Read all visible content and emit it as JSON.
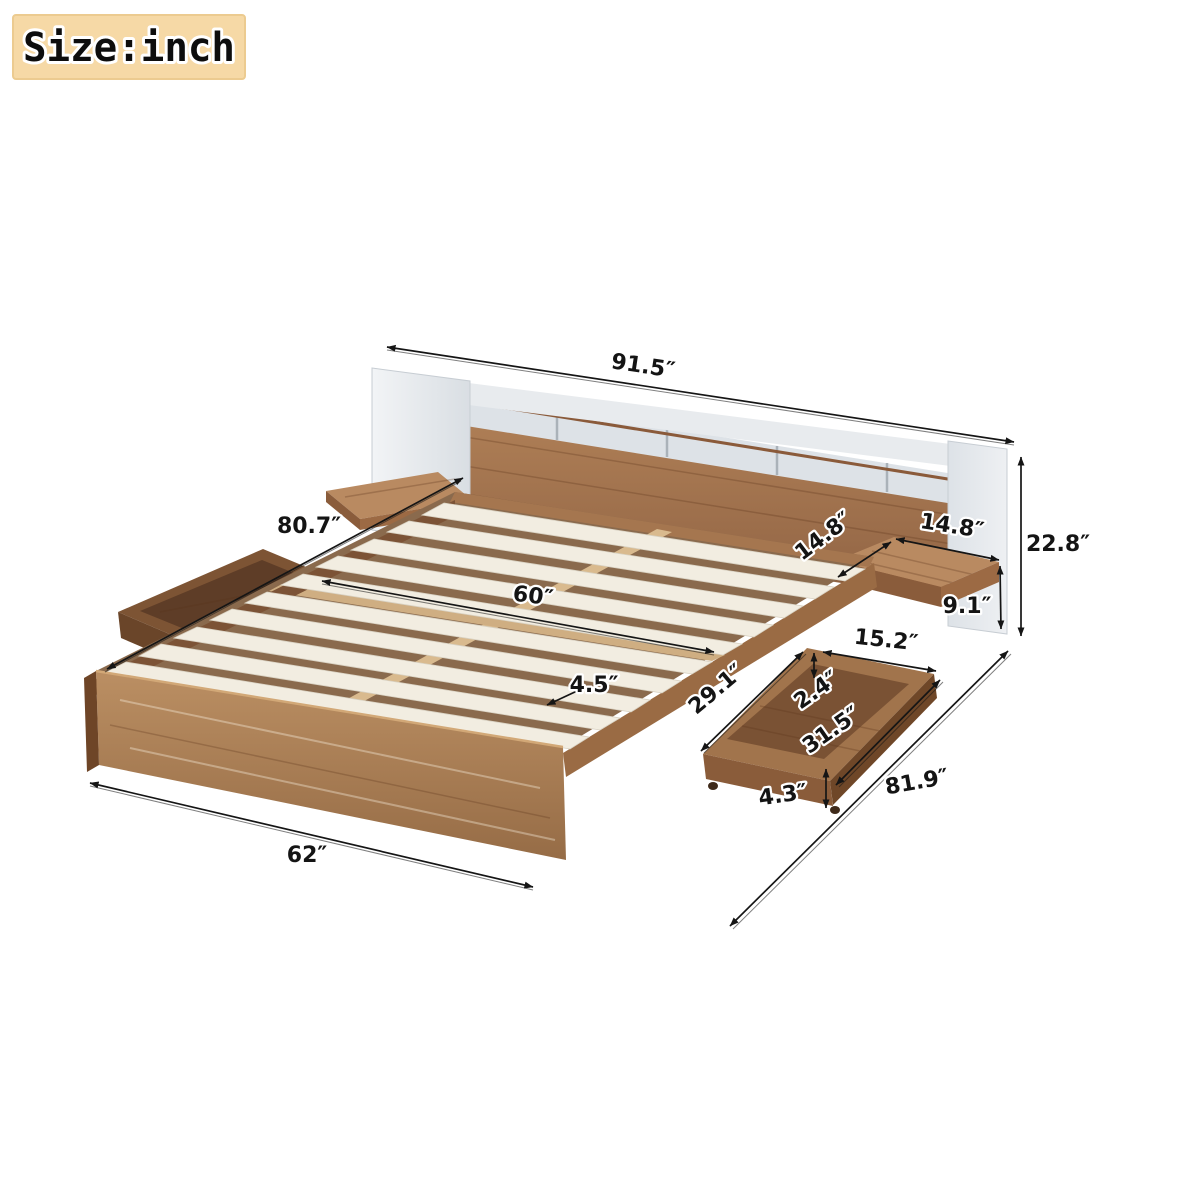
{
  "badge": {
    "label": "Size:inch"
  },
  "diagram": {
    "title": "Bed frame with headboard storage, floating shelves and under-bed drawers — dimension drawing",
    "unit": "inch",
    "dimensions": {
      "headboard_width": "91.5″",
      "bed_length": "80.7″",
      "slat_span": "60″",
      "slat_width": "4.5″",
      "shelf_depth": "14.8″",
      "shelf_width": "14.8″",
      "headboard_height": "22.8″",
      "shelf_floor_height": "9.1″",
      "drawer_width": "15.2″",
      "drawer_rim_height": "2.4″",
      "drawer_inner_length": "29.1″",
      "drawer_length": "31.5″",
      "drawer_height": "4.3″",
      "total_length_diagonal": "81.9″",
      "bed_width": "62″"
    }
  },
  "colors": {
    "wood_mid": "#a87c58",
    "wood_dark": "#7d5434",
    "wood_light": "#c49a6c",
    "slat": "#f2ede1",
    "panel_white": "#e9ecef",
    "dimension_line": "#151515",
    "badge_background": "#f6d9a6"
  }
}
